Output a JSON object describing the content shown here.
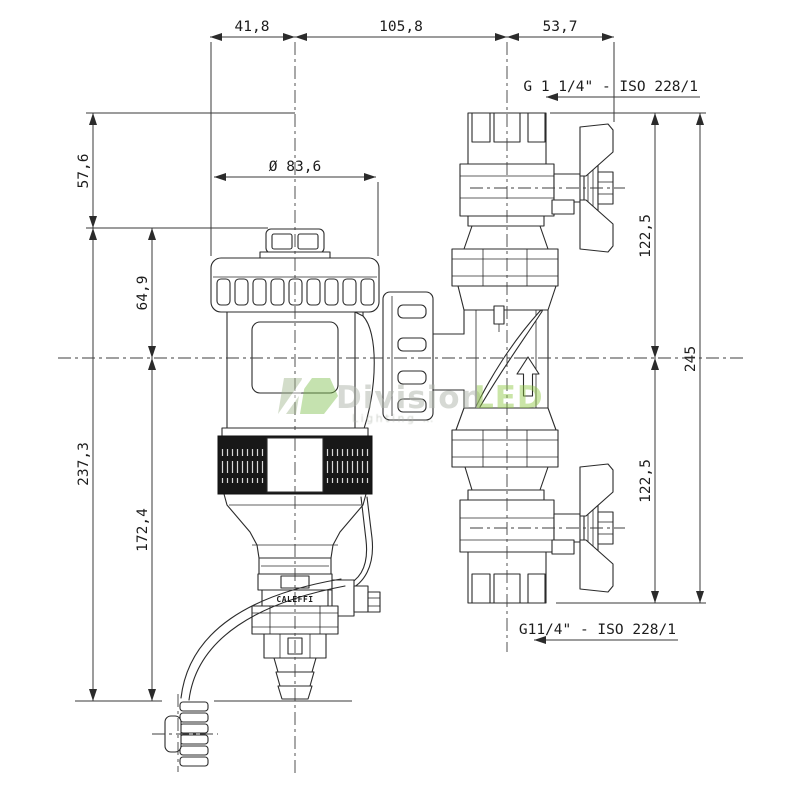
{
  "product": {
    "brand": "CALEFFI"
  },
  "dimensions": {
    "top": [
      "41,8",
      "105,8",
      "53,7"
    ],
    "cap_diameter": "Ø 83,6",
    "left": {
      "d57": "57,6",
      "d64": "64,9",
      "d237": "237,3",
      "d172": "172,4"
    },
    "right": {
      "d122_top": "122,5",
      "d122_bottom": "122,5",
      "d245": "245"
    }
  },
  "threads": {
    "top": "G 1 1/4\" - ISO 228/1",
    "bottom": "G11/4\" - ISO 228/1"
  },
  "watermark": {
    "brand_gray": "Division",
    "brand_green": "LED",
    "tagline": "Lighting …",
    "green": "#8cc63e",
    "gray": "#aeb4aa"
  },
  "style": {
    "background": "#ffffff",
    "line": "#2b2b2b",
    "dark_fill": "#181818"
  }
}
